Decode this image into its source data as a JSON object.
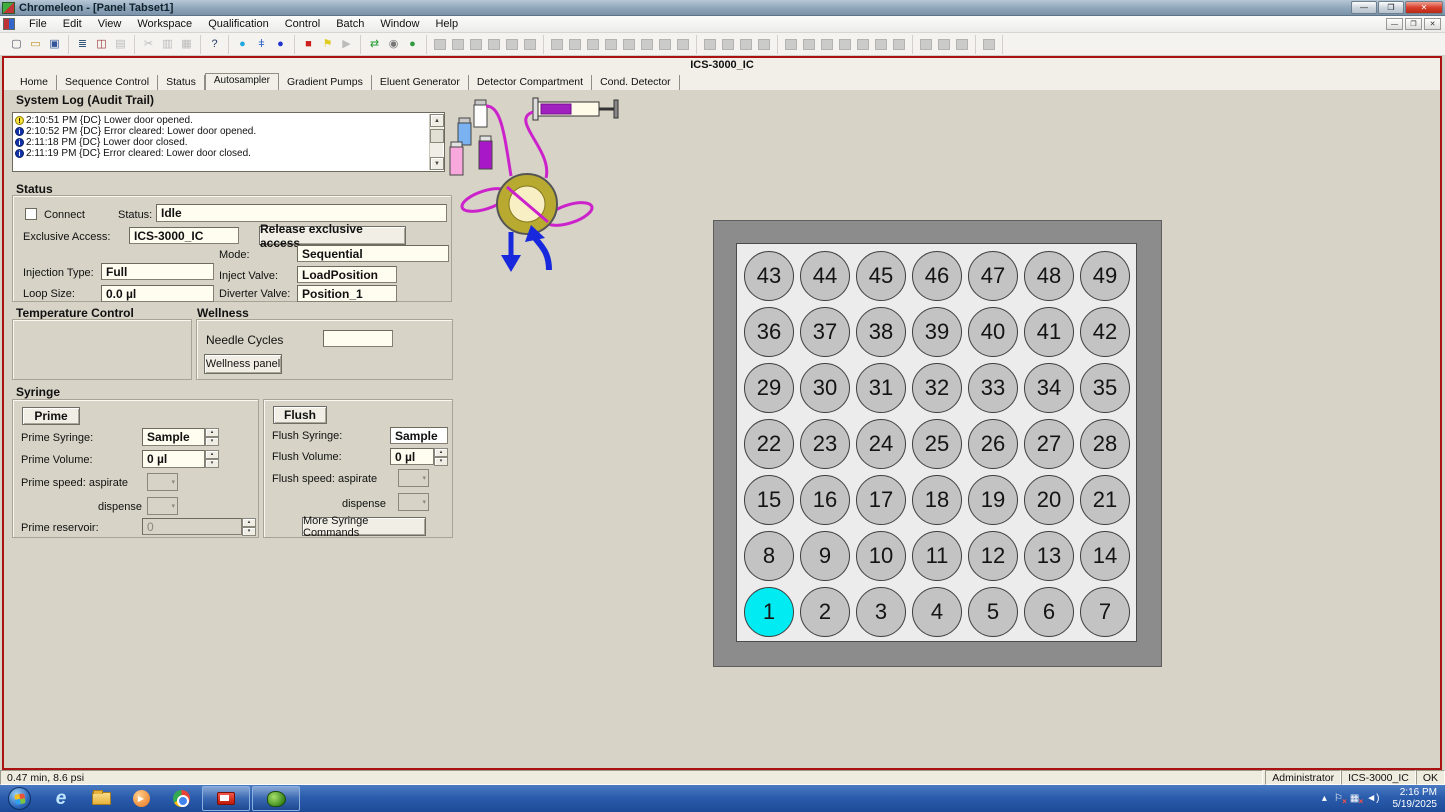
{
  "window": {
    "title": "Chromeleon - [Panel Tabset1]"
  },
  "menubar": {
    "items": [
      "File",
      "Edit",
      "View",
      "Workspace",
      "Qualification",
      "Control",
      "Batch",
      "Window",
      "Help"
    ]
  },
  "toolbar": {
    "groups": [
      [
        {
          "n": "new-file-icon",
          "g": "▢",
          "c": "#556"
        },
        {
          "n": "open-folder-icon",
          "g": "▭",
          "c": "#c09020"
        },
        {
          "n": "save-icon",
          "g": "▣",
          "c": "#335599"
        }
      ],
      [
        {
          "n": "sequence-list-icon",
          "g": "≣",
          "c": "#335577"
        },
        {
          "n": "browser-grid-icon",
          "g": "◫",
          "c": "#993333"
        },
        {
          "n": "print-icon",
          "g": "▤",
          "c": "#999",
          "d": true
        }
      ],
      [
        {
          "n": "cut-icon",
          "g": "✂",
          "c": "#9a9a9a",
          "d": true
        },
        {
          "n": "copy-icon",
          "g": "▥",
          "c": "#9a9a9a",
          "d": true
        },
        {
          "n": "paste-icon",
          "g": "▦",
          "c": "#9a9a9a",
          "d": true
        }
      ],
      [
        {
          "n": "context-help-icon",
          "g": "?",
          "c": "#223a66"
        }
      ],
      [
        {
          "n": "droplet-icon",
          "g": "●",
          "c": "#22a8dd"
        },
        {
          "n": "syringe-tool-icon",
          "g": "ǂ",
          "c": "#3366cc"
        },
        {
          "n": "record-icon",
          "g": "●",
          "c": "#2233cc"
        }
      ],
      [
        {
          "n": "stop-icon",
          "g": "■",
          "c": "#cc2020"
        },
        {
          "n": "hold-flag-icon",
          "g": "⚑",
          "c": "#e0cc20"
        },
        {
          "n": "play-icon",
          "g": "▶",
          "c": "#a0a0a0",
          "d": true
        }
      ],
      [
        {
          "n": "switch-mode-icon",
          "g": "⇄",
          "c": "#1f9a2f"
        },
        {
          "n": "find-icon",
          "g": "◉",
          "c": "#777"
        },
        {
          "n": "batch-globe-icon",
          "g": "●",
          "c": "#2f9a3f"
        }
      ],
      [
        {
          "n": "image-panel-icon",
          "b": 1,
          "d": true
        },
        {
          "n": "solid-panel-1-icon",
          "b": 1,
          "d": true
        },
        {
          "n": "solid-panel-2-icon",
          "b": 1,
          "d": true
        },
        {
          "n": "solid-panel-3-icon",
          "b": 1,
          "d": true
        },
        {
          "n": "framed-panel-icon",
          "b": 1,
          "d": true
        },
        {
          "n": "duplicate-panel-icon",
          "b": 1,
          "d": true
        }
      ],
      [
        {
          "n": "new-window-icon",
          "b": 1,
          "d": true
        },
        {
          "n": "chart-panel-icon",
          "b": 1,
          "d": true
        },
        {
          "n": "plot-grid-1-icon",
          "b": 1,
          "d": true
        },
        {
          "n": "plot-grid-2-icon",
          "b": 1,
          "d": true
        },
        {
          "n": "plot-grid-3-icon",
          "b": 1,
          "d": true
        },
        {
          "n": "plot-grid-4-icon",
          "b": 1,
          "d": true
        },
        {
          "n": "table-1-icon",
          "b": 1,
          "d": true
        },
        {
          "n": "table-2-icon",
          "b": 1,
          "d": true
        }
      ],
      [
        {
          "n": "vial-up-icon",
          "b": 1,
          "d": true
        },
        {
          "n": "vial-down-icon",
          "b": 1,
          "d": true
        },
        {
          "n": "curve-1-icon",
          "b": 1,
          "d": true
        },
        {
          "n": "curve-2-icon",
          "b": 1,
          "d": true
        }
      ],
      [
        {
          "n": "pointer-icon",
          "b": 1,
          "d": true
        },
        {
          "n": "pan-h-icon",
          "b": 1,
          "d": true
        },
        {
          "n": "pan-v-icon",
          "b": 1,
          "d": true
        },
        {
          "n": "pan-all-icon",
          "b": 1,
          "d": true
        },
        {
          "n": "select-1-icon",
          "b": 1,
          "d": true
        },
        {
          "n": "select-2-icon",
          "b": 1,
          "d": true
        },
        {
          "n": "zoom-icon",
          "b": 1,
          "d": true
        }
      ],
      [
        {
          "n": "pin-icon",
          "b": 1,
          "d": true
        },
        {
          "n": "nodes-icon",
          "b": 1,
          "d": true
        },
        {
          "n": "zoom-out-icon",
          "b": 1,
          "d": true
        }
      ],
      [
        {
          "n": "exit-door-icon",
          "b": 1,
          "d": true
        }
      ]
    ]
  },
  "panel": {
    "title": "ICS-3000_IC",
    "tabs": [
      "Home",
      "Sequence Control",
      "Status",
      "Autosampler",
      "Gradient Pumps",
      "Eluent Generator",
      "Detector Compartment",
      "Cond. Detector"
    ],
    "active_tab": "Autosampler"
  },
  "system_log": {
    "heading": "System Log (Audit Trail)",
    "entries": [
      {
        "icon": "warning",
        "text": "2:10:51 PM {DC} Lower door opened."
      },
      {
        "icon": "info",
        "text": "2:10:52 PM {DC} Error cleared: Lower door opened."
      },
      {
        "icon": "info",
        "text": "2:11:18 PM {DC} Lower door closed."
      },
      {
        "icon": "info",
        "text": "2:11:19 PM {DC} Error cleared: Lower door closed."
      }
    ]
  },
  "status": {
    "heading": "Status",
    "connect_label": "Connect",
    "status_label": "Status:",
    "status_value": "Idle",
    "exclusive_access_label": "Exclusive Access:",
    "exclusive_access_value": "ICS-3000_IC",
    "release_button": "Release exclusive access",
    "mode_label": "Mode:",
    "mode_value": "Sequential",
    "injection_type_label": "Injection Type:",
    "injection_type_value": "Full",
    "inject_valve_label": "Inject Valve:",
    "inject_valve_value": "LoadPosition",
    "loop_size_label": "Loop Size:",
    "loop_size_value": "0.0 µl",
    "diverter_valve_label": "Diverter Valve:",
    "diverter_valve_value": "Position_1"
  },
  "temperature_control": {
    "heading": "Temperature Control"
  },
  "wellness": {
    "heading": "Wellness",
    "needle_cycles_label": "Needle Cycles",
    "needle_cycles_value": "",
    "wellness_panel_button": "Wellness panel"
  },
  "syringe": {
    "heading": "Syringe",
    "prime": {
      "button": "Prime",
      "syringe_label": "Prime Syringe:",
      "syringe_value": "Sample",
      "volume_label": "Prime Volume:",
      "volume_value": "0 µl",
      "speed_label": "Prime speed: aspirate",
      "dispense_label": "dispense",
      "reservoir_label": "Prime reservoir:",
      "reservoir_value": "0"
    },
    "flush": {
      "button": "Flush",
      "syringe_label": "Flush Syringe:",
      "syringe_value": "Sample",
      "volume_label": "Flush Volume:",
      "volume_value": "0 µl",
      "speed_label": "Flush speed: aspirate",
      "dispense_label": "dispense",
      "more_button": "More Syringe Commands"
    }
  },
  "tray": {
    "rows": [
      [
        43,
        44,
        45,
        46,
        47,
        48,
        49
      ],
      [
        36,
        37,
        38,
        39,
        40,
        41,
        42
      ],
      [
        29,
        30,
        31,
        32,
        33,
        34,
        35
      ],
      [
        22,
        23,
        24,
        25,
        26,
        27,
        28
      ],
      [
        15,
        16,
        17,
        18,
        19,
        20,
        21
      ],
      [
        8,
        9,
        10,
        11,
        12,
        13,
        14
      ],
      [
        1,
        2,
        3,
        4,
        5,
        6,
        7
      ]
    ],
    "selected_position": 1,
    "selected_color": "#00ecf2",
    "default_color": "#c3c3c3"
  },
  "statusbar": {
    "left_text": "0.47 min, 8.6 psi",
    "user": "Administrator",
    "instrument": "ICS-3000_IC",
    "state": "OK"
  },
  "taskbar": {
    "time": "2:16 PM",
    "date": "5/19/2025"
  }
}
